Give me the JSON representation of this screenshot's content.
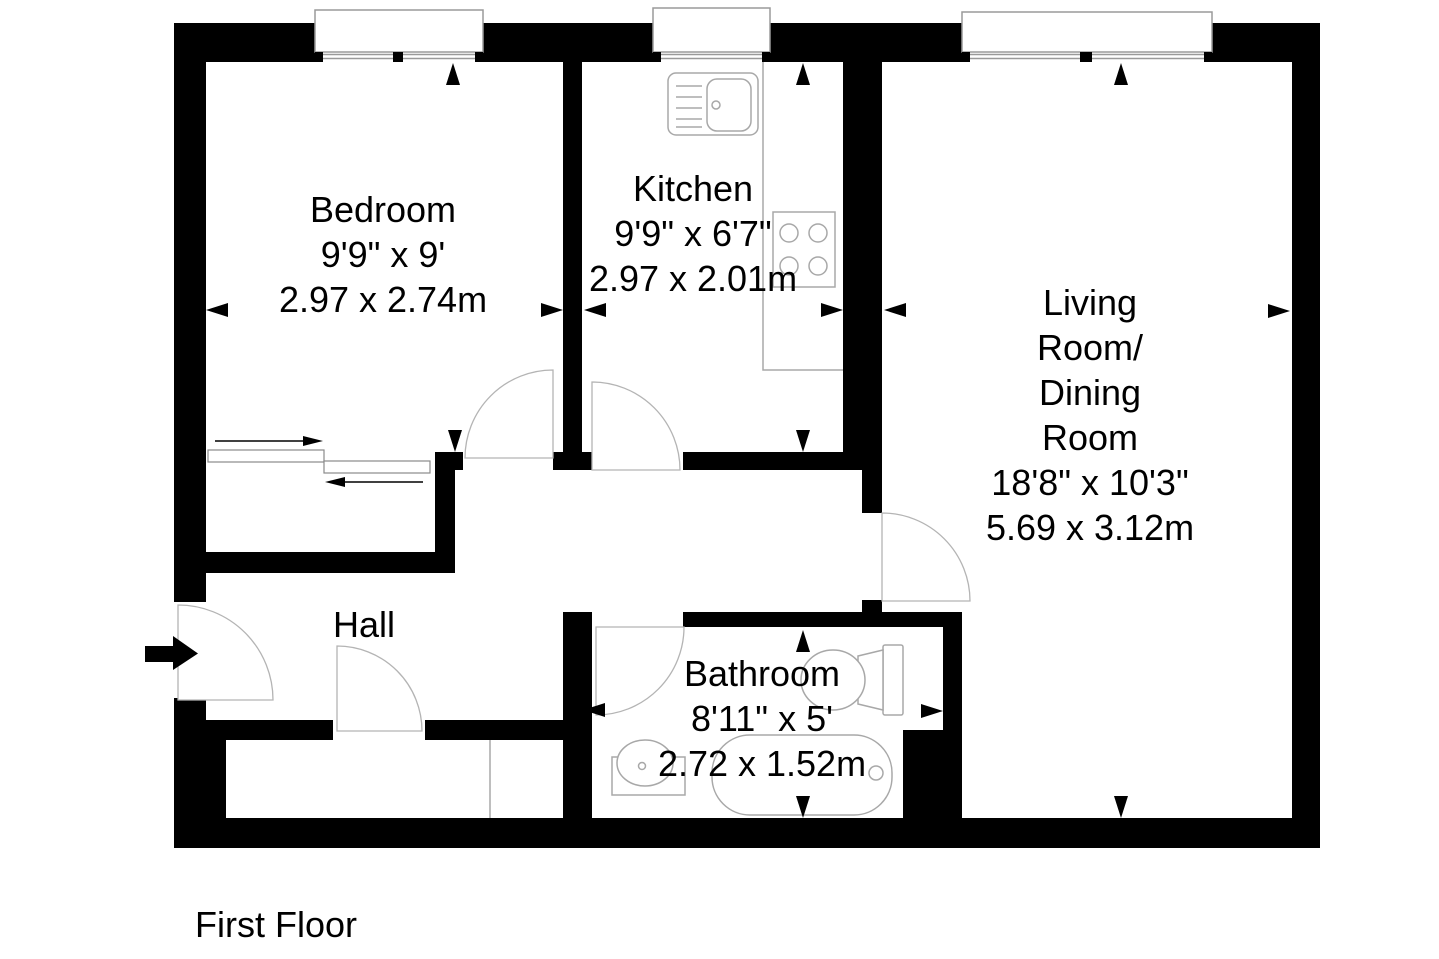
{
  "floor_label": "First Floor",
  "rooms": {
    "bedroom": {
      "name": "Bedroom",
      "size_ft": "9'9\" x 9'",
      "size_m": "2.97 x 2.74m"
    },
    "kitchen": {
      "name": "Kitchen",
      "size_ft": "9'9\" x 6'7\"",
      "size_m": "2.97 x 2.01m"
    },
    "living_dining": {
      "name_lines": [
        "Living",
        "Room/",
        "Dining",
        "Room"
      ],
      "size_ft": "18'8\" x 10'3\"",
      "size_m": "5.69 x 3.12m"
    },
    "bathroom": {
      "name": "Bathroom",
      "size_ft": "8'11\" x 5'",
      "size_m": "2.72 x 1.52m"
    },
    "hall": {
      "name": "Hall"
    }
  },
  "colors": {
    "walls": "#000000",
    "text": "#000000",
    "fixture_outline": "#a8a8a8",
    "background": "#ffffff"
  },
  "icons": {
    "entrance": "entry-direction-arrow",
    "dimension_markers": "solid-triangle-dimension-arrows",
    "fixtures": [
      "kitchen-sink",
      "hob",
      "toilet",
      "washbasin",
      "bathtub"
    ]
  }
}
